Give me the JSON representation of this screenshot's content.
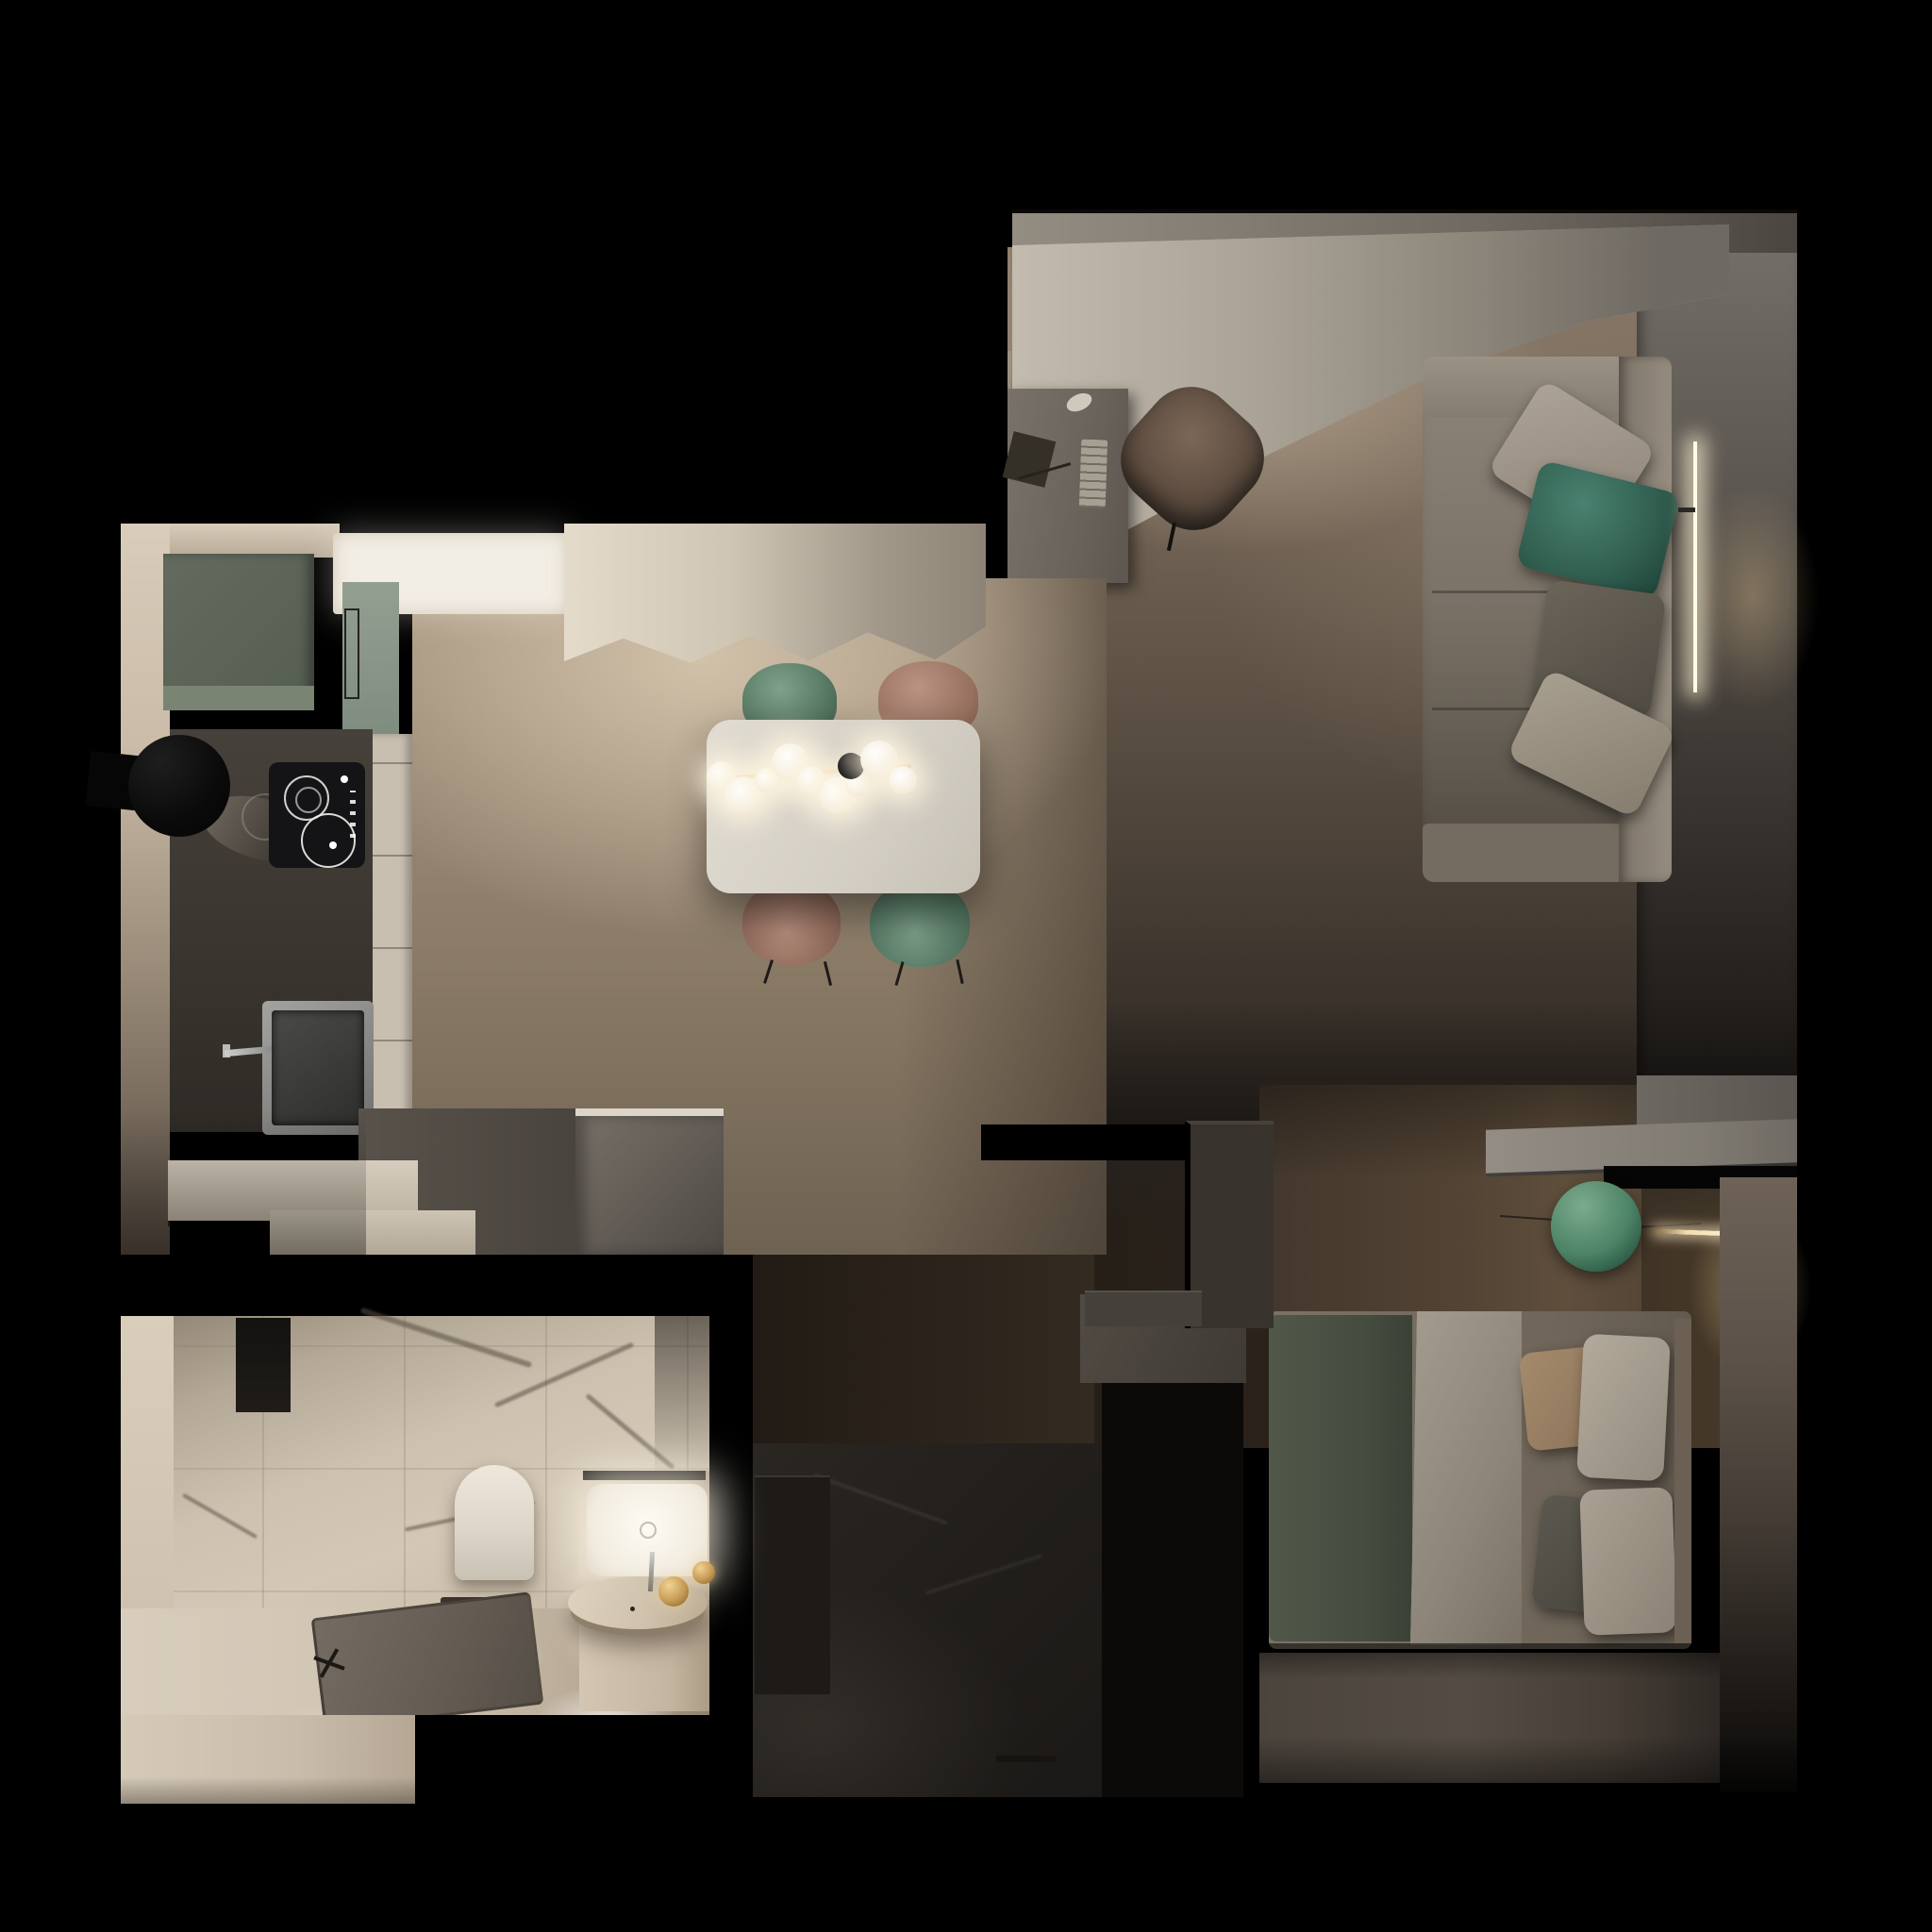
{
  "scene": {
    "type": "3d-floorplan-top-down-render",
    "title": "Top-down night render of a one-bedroom apartment",
    "background": "#000000",
    "lights_on": true
  },
  "palette": {
    "bg": "#000000",
    "wood_floor_kitchen": "#a4937e",
    "wood_floor_living": "#6a5d50",
    "wood_wall_dark": "#2c241d",
    "curtain_cream": "#ddd4c4",
    "curtain_gray": "#8b857a",
    "cabinet_sage_dark": "#5d6458",
    "cabinet_sage_light": "#8c998c",
    "counter_dark": "#413c36",
    "marble_light": "#d3c8b8",
    "table_white": "#dcd7cd",
    "chair_green": "#6e8d7b",
    "chair_rose": "#b08a7a",
    "steel_gray": "#9a9a98",
    "step_white": "#cfc6b8",
    "island_gray": "#6e6861",
    "sofa_beige": "#8a8176",
    "pillow_teal": "#336053",
    "pillow_gray": "#5b574f",
    "pillow_light": "#918a7e",
    "desk_gray": "#6e675e",
    "chair_tan": "#6e5a4e",
    "lamp_glow": "#e8c79a",
    "shelf_gray": "#8b857d",
    "sphere_green": "#4f8468",
    "duvet_green": "#4c5349",
    "sheet_beige": "#9a9286",
    "pillow_tan": "#9d8368",
    "pillow_white": "#a89f92",
    "pillow_graphite": "#55534b",
    "bedroom_wall": "#6b6157",
    "hall_marble_dark": "#26221f",
    "bath_marble": "#c9bdad",
    "bath_floor_bright": "#e9e0d2",
    "toilet_white": "#e4ddd1",
    "shower_tray_gray": "#6b6258",
    "vanity_cream": "#cfc2ae",
    "basin_white": "#f6f2e9",
    "brass_gold": "#c29455",
    "black_accent": "#121110"
  },
  "rooms": {
    "kitchen_dining": {
      "name": "Kitchen and dining room",
      "furniture": [
        "sage-upper-cabinet",
        "tall-sage-cabinet",
        "cooker-hood",
        "induction-hob",
        "dark-countertop",
        "kitchen-sink",
        "sink-faucet",
        "marble-ledge",
        "ceiling-light-recess",
        "window-curtains",
        "dining-table",
        "brass-chandelier",
        "glass-globe-bulbs",
        "black-globe-bulb",
        "dining-chair-green-top",
        "dining-chair-rose-top",
        "dining-chair-rose-bottom",
        "dining-chair-green-bottom",
        "entry-steps",
        "island-cabinet",
        "oak-plank-floor"
      ]
    },
    "living_study": {
      "name": "Living room and study",
      "furniture": [
        "curtain-pelmet",
        "sheer-window-curtains",
        "work-desk",
        "flat-laptop",
        "keyboard",
        "mouse",
        "desk-chair-tan",
        "sofa",
        "sofa-cushion-light",
        "sofa-cushion-teal",
        "sofa-cushion-gray",
        "sofa-cushion-cream",
        "vertical-led-wall-light",
        "gray-accent-wall",
        "oak-plank-floor"
      ]
    },
    "bedroom": {
      "name": "Bedroom",
      "furniture": [
        "wood-accent-wall",
        "floating-shelf",
        "green-globe-pendant",
        "brass-wall-light",
        "double-bed",
        "green-duvet",
        "draped-sheet",
        "pillow-tan",
        "pillow-white-top",
        "pillow-graphite",
        "pillow-white-bottom",
        "headboard-bench",
        "warm-accent-wall",
        "floor"
      ]
    },
    "hallway": {
      "name": "Hallway",
      "furniture": [
        "dark-wood-partition",
        "dark-marble-floor",
        "storage-cabinet",
        "partition-half-wall",
        "door-threshold-handle"
      ]
    },
    "bathroom": {
      "name": "Bathroom",
      "furniture": [
        "marble-tile-walls",
        "black-towel-cabinet",
        "wall-hung-toilet",
        "linear-floor-drain",
        "shower-tray",
        "shower-cross-valve",
        "vanity-counter",
        "rectangular-basin-lit",
        "round-vessel-tray",
        "basin-faucet",
        "brass-sphere-lamp-large",
        "brass-sphere-lamp-small",
        "polished-marble-floor"
      ]
    }
  },
  "chandelier": {
    "white_globes": 9,
    "black_globes": 1
  }
}
